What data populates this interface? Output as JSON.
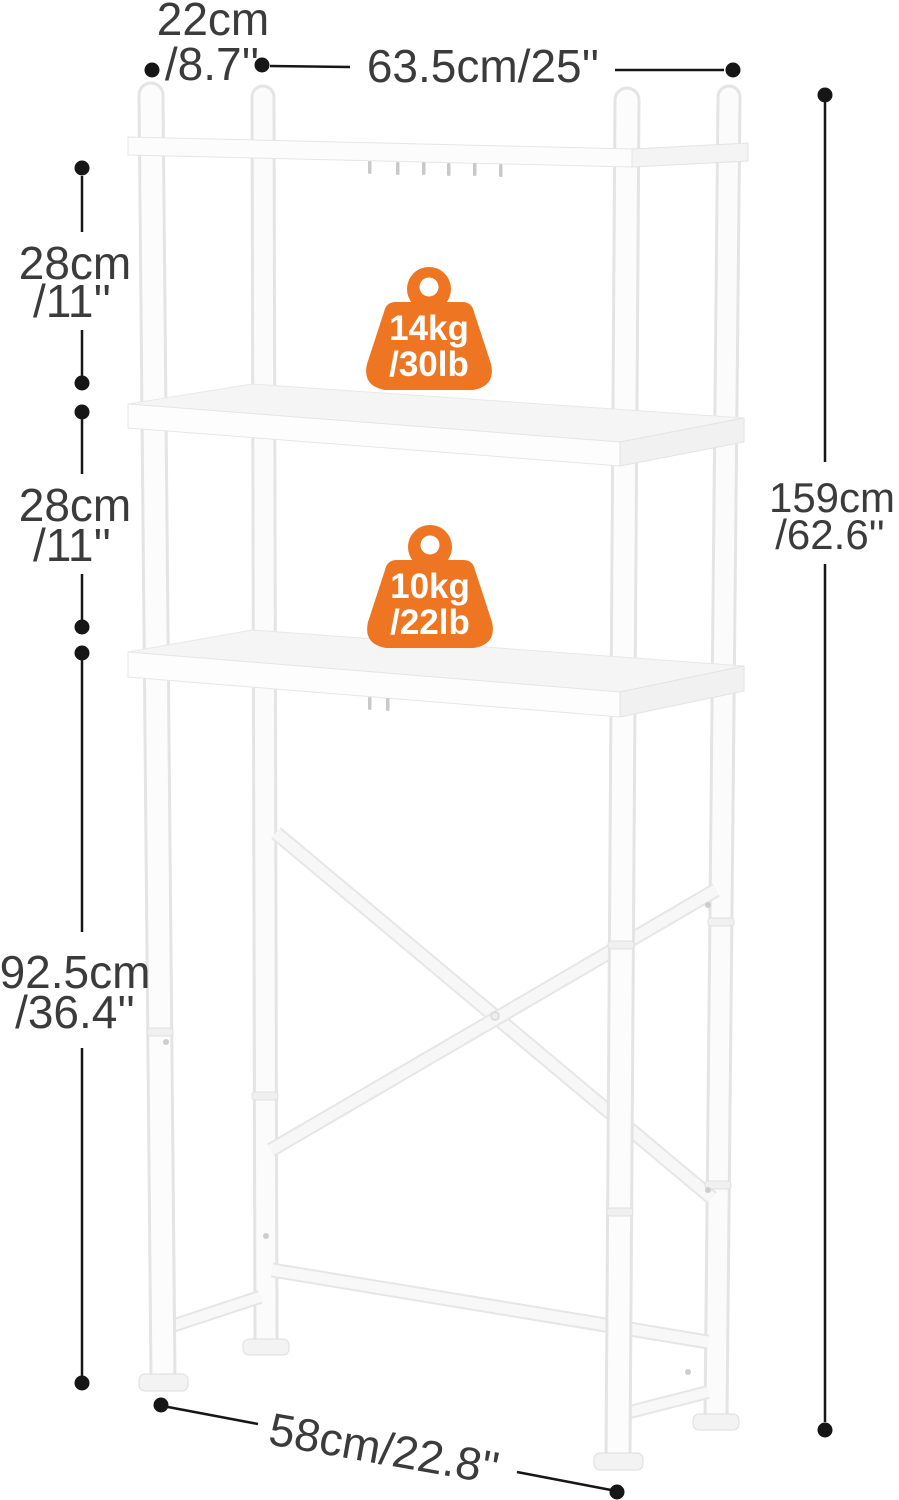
{
  "image_type": "product-dimension-diagram",
  "product": {
    "description": "white 3-tier over-the-toilet storage rack with X cross brace",
    "finish_color": "#fafafa"
  },
  "colors": {
    "badge_orange": "#ee7522",
    "dimension_text": "#3b3b3b",
    "dimension_line": "#161616",
    "rack_fill": "#fbfbfb",
    "rack_edge": "#e5e5e5"
  },
  "icons": {
    "weight_capacity": "kettlebell-icon"
  },
  "dimensions": {
    "top_depth": {
      "cm": "22cm",
      "inch": "/8.7''"
    },
    "top_width": {
      "label": "63.5cm/25''"
    },
    "upper_gap": {
      "cm": "28cm",
      "inch": "/11''"
    },
    "middle_gap": {
      "cm": "28cm",
      "inch": "/11''"
    },
    "leg_height": {
      "cm": "92.5cm",
      "inch": "/36.4''"
    },
    "total_height": {
      "cm": "159cm",
      "inch": "/62.6''"
    },
    "bottom_width": {
      "label": "58cm/22.8''"
    }
  },
  "badges": [
    {
      "weight_kg": "14kg",
      "weight_lb": "/30lb"
    },
    {
      "weight_kg": "10kg",
      "weight_lb": "/22lb"
    }
  ]
}
